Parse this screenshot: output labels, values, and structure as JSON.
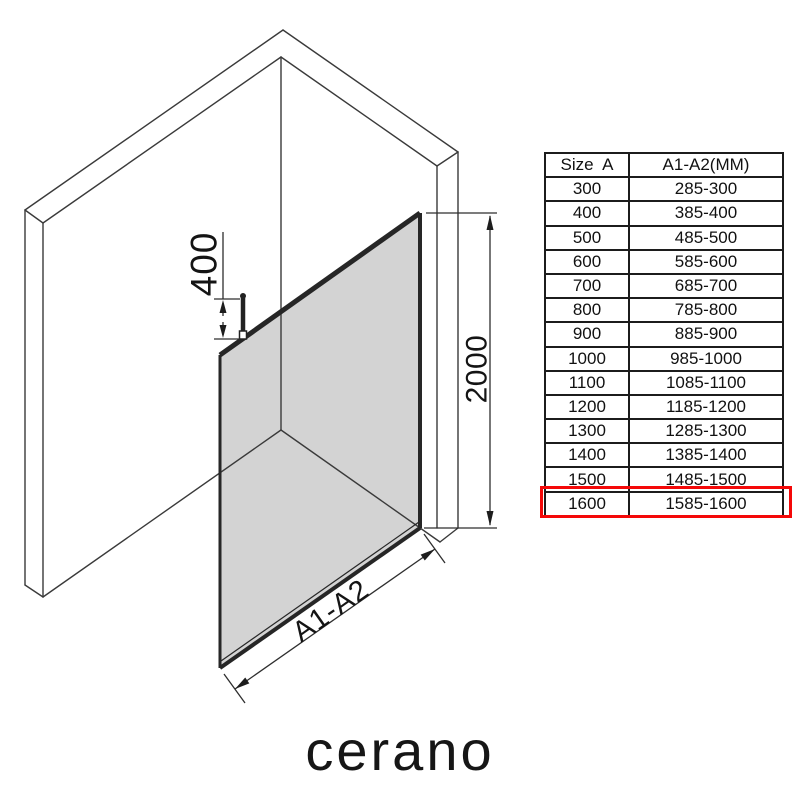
{
  "brand": {
    "logo_text": "cerano"
  },
  "diagram": {
    "description": "isometric walk-in shower glass panel installation drawing",
    "dim_bracket_label": "400",
    "dim_height_label": "2000",
    "dim_width_label": "A1-A2",
    "glass_color": "#d3d3d3",
    "line_color": "#3a3a3a"
  },
  "table": {
    "headers": [
      "Size  A",
      "A1-A2(MM)"
    ],
    "rows": [
      {
        "size": "300",
        "range": "285-300"
      },
      {
        "size": "400",
        "range": "385-400"
      },
      {
        "size": "500",
        "range": "485-500"
      },
      {
        "size": "600",
        "range": "585-600"
      },
      {
        "size": "700",
        "range": "685-700"
      },
      {
        "size": "800",
        "range": "785-800"
      },
      {
        "size": "900",
        "range": "885-900"
      },
      {
        "size": "1000",
        "range": "985-1000"
      },
      {
        "size": "1100",
        "range": "1085-1100"
      },
      {
        "size": "1200",
        "range": "1185-1200"
      },
      {
        "size": "1300",
        "range": "1285-1300"
      },
      {
        "size": "1400",
        "range": "1385-1400"
      },
      {
        "size": "1500",
        "range": "1485-1500"
      },
      {
        "size": "1600",
        "range": "1585-1600"
      }
    ],
    "highlight": {
      "row_size": "1600",
      "color": "#f40808"
    }
  }
}
